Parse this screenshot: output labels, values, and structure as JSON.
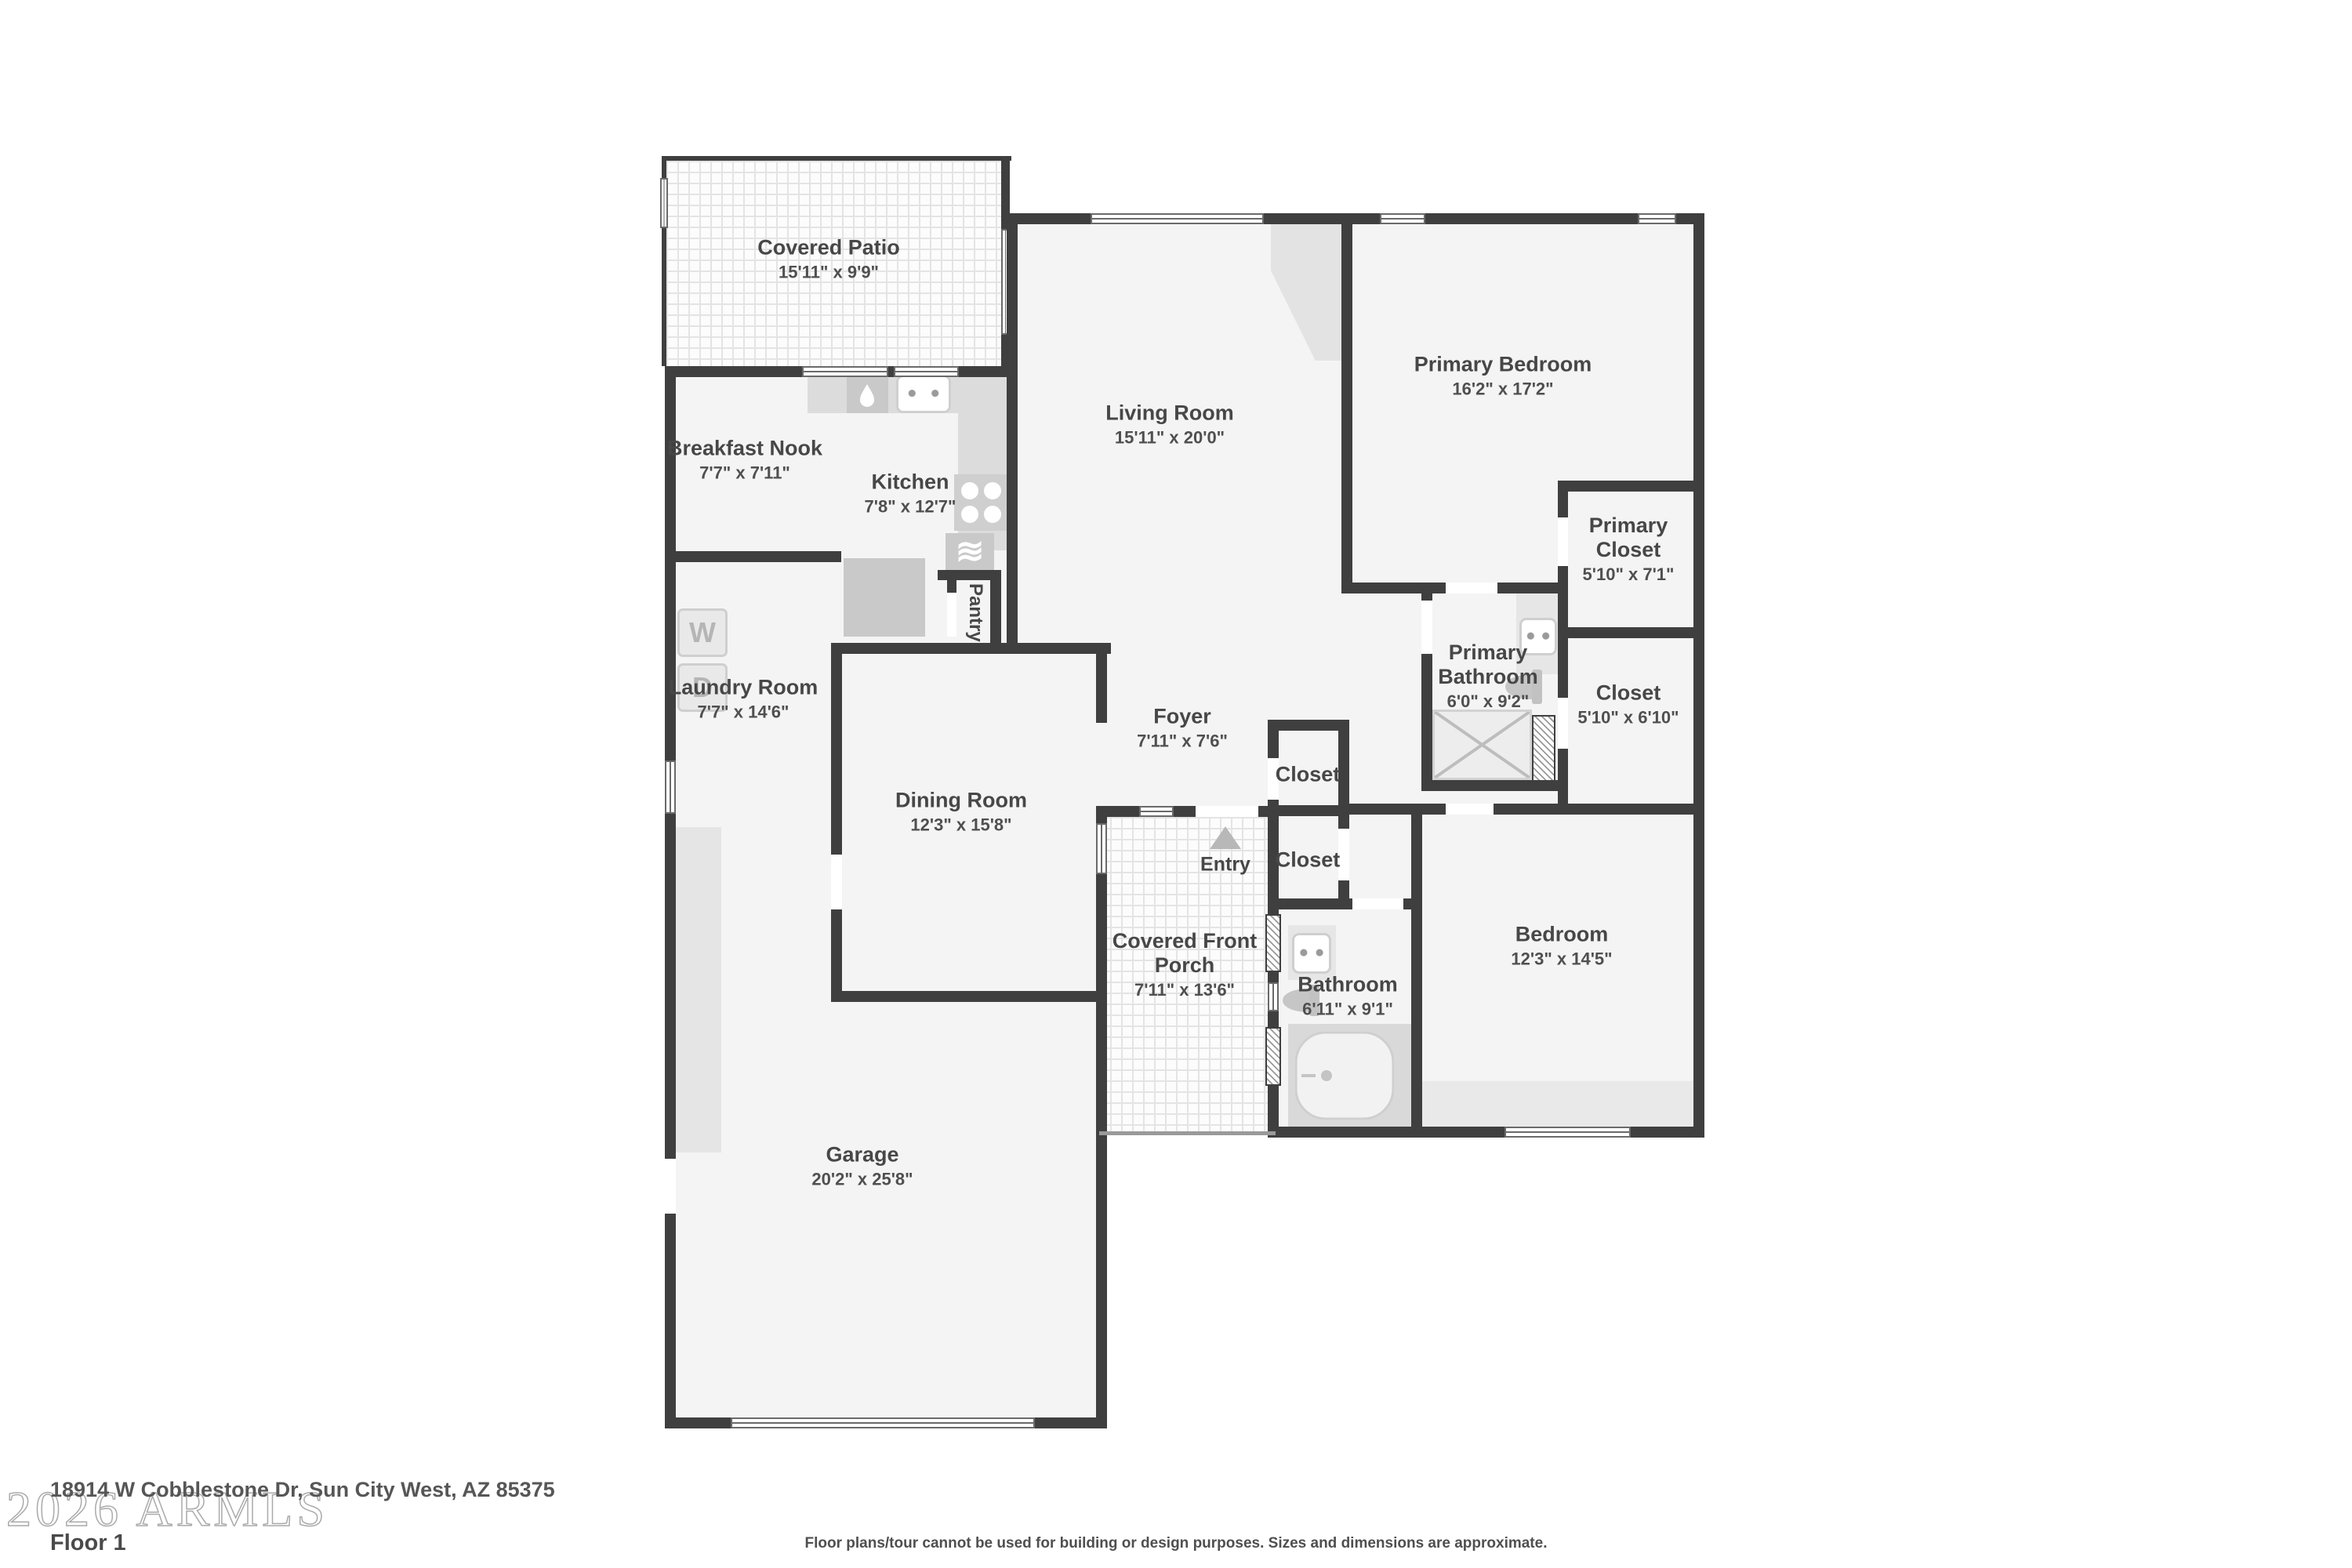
{
  "meta": {
    "watermark": "2026 ARMLS",
    "address": "18914 W Cobblestone Dr, Sun City West, AZ 85375",
    "floor_label": "Floor 1",
    "disclaimer": "Floor plans/tour cannot be used for building or design purposes. Sizes and dimensions are approximate."
  },
  "labels": {
    "entry": "Entry",
    "pantry": "Pantry",
    "washer": "W",
    "dryer": "D"
  },
  "colors": {
    "wall": "#3f3f3f",
    "room_fill": "#f4f4f4",
    "fixture": "#d9d9d9",
    "text": "#474747"
  },
  "rooms": [
    {
      "id": "covered-patio",
      "name": "Covered Patio",
      "dims": "15'11\" x 9'9\""
    },
    {
      "id": "breakfast-nook",
      "name": "Breakfast Nook",
      "dims": "7'7\" x 7'11\""
    },
    {
      "id": "kitchen",
      "name": "Kitchen",
      "dims": "7'8\" x 12'7\""
    },
    {
      "id": "living-room",
      "name": "Living Room",
      "dims": "15'11\" x 20'0\""
    },
    {
      "id": "primary-bedroom",
      "name": "Primary Bedroom",
      "dims": "16'2\" x 17'2\""
    },
    {
      "id": "primary-closet",
      "name": "Primary Closet",
      "dims": "5'10\" x 7'1\""
    },
    {
      "id": "closet-right",
      "name": "Closet",
      "dims": "5'10\" x 6'10\""
    },
    {
      "id": "primary-bathroom",
      "name": "Primary Bathroom",
      "dims": "6'0\" x 9'2\""
    },
    {
      "id": "laundry-room",
      "name": "Laundry Room",
      "dims": "7'7\" x 14'6\""
    },
    {
      "id": "dining-room",
      "name": "Dining Room",
      "dims": "12'3\" x 15'8\""
    },
    {
      "id": "foyer",
      "name": "Foyer",
      "dims": "7'11\" x 7'6\""
    },
    {
      "id": "closet-foyer-upper",
      "name": "Closet",
      "dims": ""
    },
    {
      "id": "closet-foyer-lower",
      "name": "Closet",
      "dims": ""
    },
    {
      "id": "covered-front-porch",
      "name": "Covered Front Porch",
      "dims": "7'11\" x 13'6\""
    },
    {
      "id": "bathroom",
      "name": "Bathroom",
      "dims": "6'11\" x 9'1\""
    },
    {
      "id": "bedroom",
      "name": "Bedroom",
      "dims": "12'3\" x 14'5\""
    },
    {
      "id": "garage",
      "name": "Garage",
      "dims": "20'2\" x 25'8\""
    }
  ]
}
